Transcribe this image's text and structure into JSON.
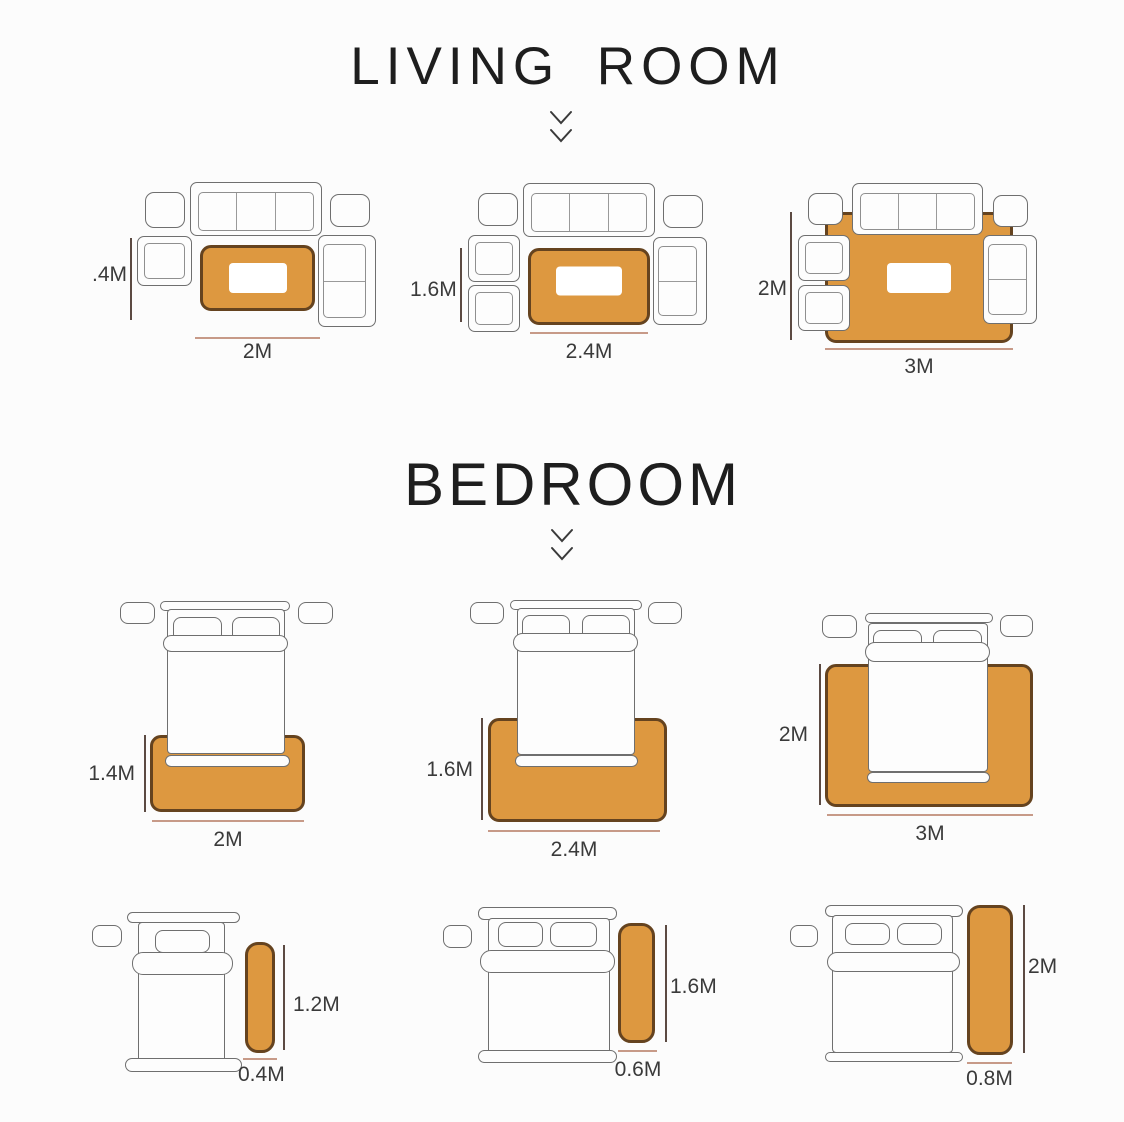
{
  "sections": {
    "living_room": {
      "title": "LIVING ROOM",
      "diagrams": [
        {
          "height": ".4M",
          "width": "2M"
        },
        {
          "height": "1.6M",
          "width": "2.4M"
        },
        {
          "height": "2M",
          "width": "3M"
        }
      ]
    },
    "bedroom": {
      "title": "BEDROOM",
      "bed_rugs": [
        {
          "height": "1.4M",
          "width": "2M"
        },
        {
          "height": "1.6M",
          "width": "2.4M"
        },
        {
          "height": "2M",
          "width": "3M"
        }
      ],
      "runner_rugs": [
        {
          "height": "1.2M",
          "width": "0.4M"
        },
        {
          "height": "1.6M",
          "width": "0.6M"
        },
        {
          "height": "2M",
          "width": "0.8M"
        }
      ]
    }
  },
  "colors": {
    "background": "#fcfcfc",
    "rug_fill": "#dd9840",
    "rug_border": "#65431f",
    "furniture_outline": "#6f6f6f",
    "dimension_line_vertical": "#5c4a42",
    "dimension_line_horizontal": "#c79a88",
    "label_text": "#3a3a3a"
  },
  "icons": {
    "section_pointer": "double-chevron-down-icon"
  }
}
